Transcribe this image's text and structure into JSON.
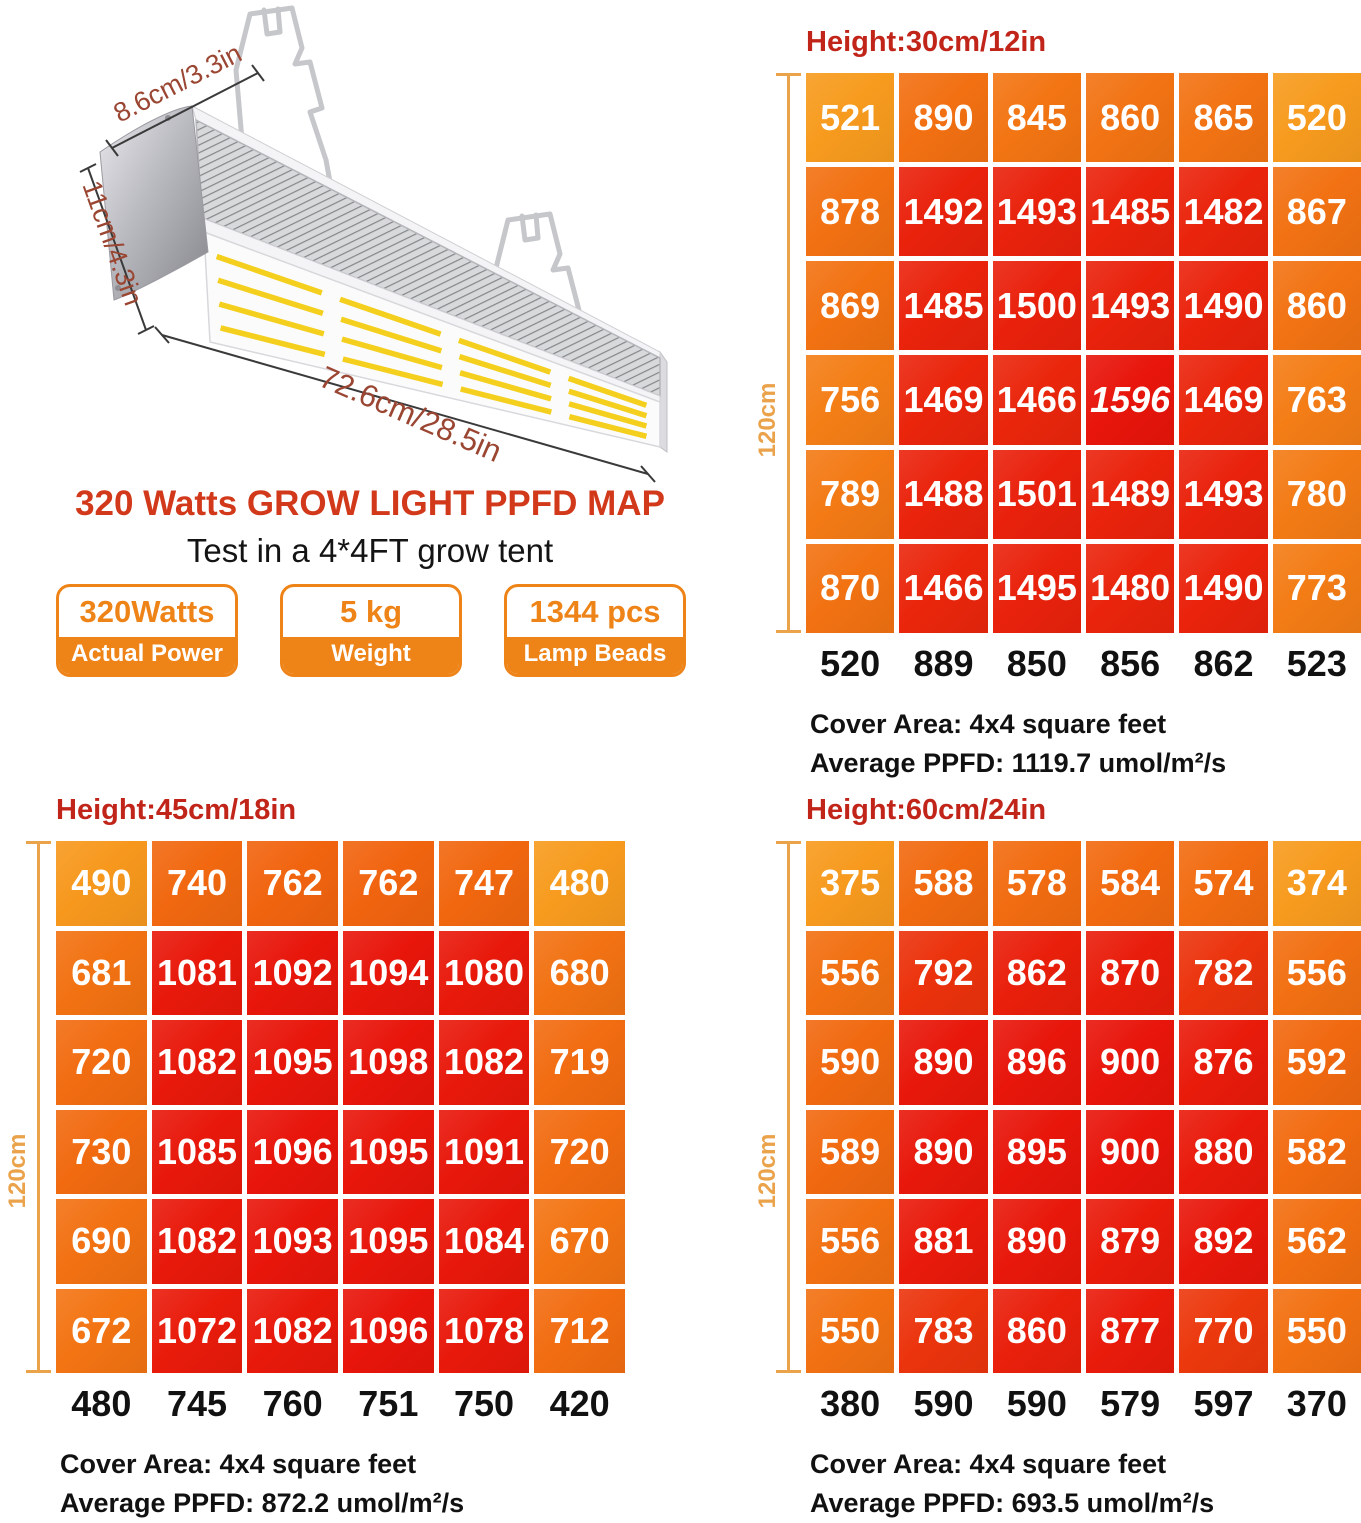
{
  "product": {
    "title": "320 Watts GROW LIGHT PPFD MAP",
    "subtitle": "Test in a 4*4FT grow tent",
    "badges": [
      {
        "value": "320Watts",
        "label": "Actual Power"
      },
      {
        "value": "5 kg",
        "label": "Weight"
      },
      {
        "value": "1344 pcs",
        "label": "Lamp Beads"
      }
    ],
    "dimensions": {
      "depth": "8.6cm/3.3in",
      "height": "11cm/4.3in",
      "length": "72.6cm/28.5in"
    }
  },
  "colors": {
    "map_header_red": "#c1251a",
    "title_red": "#d2391b",
    "badge_orange": "#ee8418",
    "ruler_tan": "#eaa24b",
    "heat_low": "#f79b1e",
    "heat_mid": "#f1660f",
    "heat_high": "#e8150b"
  },
  "chart_data": [
    {
      "type": "heatmap",
      "title": "Height:30cm/12in",
      "ruler_label": "120cm",
      "rows": [
        [
          521,
          890,
          845,
          860,
          865,
          520
        ],
        [
          878,
          1492,
          1493,
          1485,
          1482,
          867
        ],
        [
          869,
          1485,
          1500,
          1493,
          1490,
          860
        ],
        [
          756,
          1469,
          1466,
          1596,
          1469,
          763
        ],
        [
          789,
          1488,
          1501,
          1489,
          1493,
          780
        ],
        [
          870,
          1466,
          1495,
          1480,
          1490,
          773
        ]
      ],
      "italic_values": [
        1596
      ],
      "x_axis": [
        520,
        889,
        850,
        856,
        862,
        523
      ],
      "cover_area": "Cover Area: 4x4 square feet",
      "average_ppfd": "Average PPFD:  1119.7 umol/m²/s"
    },
    {
      "type": "heatmap",
      "title": "Height:45cm/18in",
      "ruler_label": "120cm",
      "rows": [
        [
          490,
          740,
          762,
          762,
          747,
          480
        ],
        [
          681,
          1081,
          1092,
          1094,
          1080,
          680
        ],
        [
          720,
          1082,
          1095,
          1098,
          1082,
          719
        ],
        [
          730,
          1085,
          1096,
          1095,
          1091,
          720
        ],
        [
          690,
          1082,
          1093,
          1095,
          1084,
          670
        ],
        [
          672,
          1072,
          1082,
          1096,
          1078,
          712
        ]
      ],
      "italic_values": [],
      "x_axis": [
        480,
        745,
        760,
        751,
        750,
        420
      ],
      "cover_area": "Cover Area: 4x4 square feet",
      "average_ppfd": "Average PPFD: 872.2 umol/m²/s"
    },
    {
      "type": "heatmap",
      "title": "Height:60cm/24in",
      "ruler_label": "120cm",
      "rows": [
        [
          375,
          588,
          578,
          584,
          574,
          374
        ],
        [
          556,
          792,
          862,
          870,
          782,
          556
        ],
        [
          590,
          890,
          896,
          900,
          876,
          592
        ],
        [
          589,
          890,
          895,
          900,
          880,
          582
        ],
        [
          556,
          881,
          890,
          879,
          892,
          562
        ],
        [
          550,
          783,
          860,
          877,
          770,
          550
        ]
      ],
      "italic_values": [],
      "x_axis": [
        380,
        590,
        590,
        579,
        597,
        370
      ],
      "cover_area": "Cover Area: 4x4 square feet",
      "average_ppfd": "Average PPFD: 693.5 umol/m²/s"
    }
  ]
}
